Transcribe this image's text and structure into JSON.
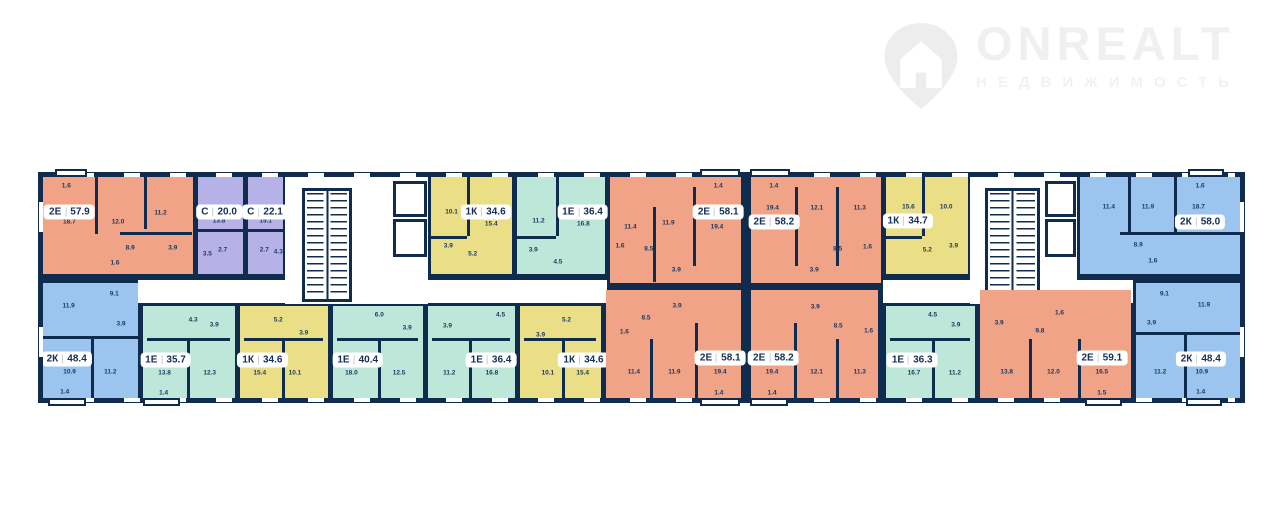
{
  "watermark": {
    "brand": "ONREALT",
    "subtitle": "НЕДВИЖИМОСТЬ"
  },
  "palette": {
    "wall": "#0f2b4d",
    "orange": "#f0a386",
    "purple": "#b6b2e8",
    "yellow": "#eadf86",
    "teal": "#bde7d8",
    "blue": "#9bc5ee",
    "paper": "#ffffff"
  },
  "building": {
    "x": 38,
    "y": 172,
    "w": 1207,
    "h": 231
  },
  "corridors": [
    {
      "x": 100,
      "y": 108,
      "w": 469,
      "h": 23
    },
    {
      "x": 845,
      "y": 108,
      "w": 250,
      "h": 23
    }
  ],
  "cores": [
    {
      "x": 247,
      "y": 0,
      "w": 143,
      "h": 132
    },
    {
      "x": 932,
      "y": 0,
      "w": 107,
      "h": 132
    }
  ],
  "stairs": [
    {
      "x": 264,
      "y": 16,
      "w": 50,
      "h": 114
    },
    {
      "x": 947,
      "y": 16,
      "w": 55,
      "h": 114
    }
  ],
  "elevators": [
    {
      "x": 355,
      "y": 9,
      "w": 34,
      "h": 36
    },
    {
      "x": 355,
      "y": 47,
      "w": 34,
      "h": 38
    },
    {
      "x": 1007,
      "y": 9,
      "w": 31,
      "h": 36
    },
    {
      "x": 1007,
      "y": 47,
      "w": 31,
      "h": 38
    }
  ],
  "balconies": [
    {
      "x": 17,
      "w": 32,
      "side": "top"
    },
    {
      "x": 662,
      "w": 40,
      "side": "top"
    },
    {
      "x": 712,
      "w": 40,
      "side": "top"
    },
    {
      "x": 1150,
      "w": 36,
      "side": "top"
    },
    {
      "x": 10,
      "w": 38,
      "side": "bottom"
    },
    {
      "x": 105,
      "w": 37,
      "side": "bottom"
    },
    {
      "x": 662,
      "w": 40,
      "side": "bottom"
    },
    {
      "x": 712,
      "w": 38,
      "side": "bottom"
    },
    {
      "x": 1047,
      "w": 37,
      "side": "bottom"
    },
    {
      "x": 1148,
      "w": 36,
      "side": "bottom"
    }
  ],
  "units": [
    {
      "id": "t1",
      "type": "2Е",
      "area": "57.9",
      "color": "orange",
      "x": 0,
      "y": 0,
      "w": 157,
      "h": 104,
      "badge": {
        "x": 19,
        "y": 38
      },
      "rooms": [
        {
          "v": "1.6",
          "x": 17,
          "y": 12
        },
        {
          "v": "18.7",
          "x": 19,
          "y": 48
        },
        {
          "v": "12.0",
          "x": 51,
          "y": 48
        },
        {
          "v": "11.2",
          "x": 79,
          "y": 39
        },
        {
          "v": "8.9",
          "x": 59,
          "y": 74
        },
        {
          "v": "3.9",
          "x": 87,
          "y": 74
        },
        {
          "v": "1.6",
          "x": 49,
          "y": 89
        }
      ],
      "walls": [
        {
          "o": "v",
          "p": 36,
          "a": 0,
          "b": 60
        },
        {
          "o": "v",
          "p": 68,
          "a": 0,
          "b": 55
        },
        {
          "o": "h",
          "p": 58,
          "a": 52,
          "b": 100
        }
      ]
    },
    {
      "id": "t2",
      "type": "С",
      "area": "20.0",
      "color": "purple",
      "x": 157,
      "y": 0,
      "w": 50,
      "h": 104,
      "badge": {
        "x": 48,
        "y": 38
      },
      "rooms": [
        {
          "v": "13.8",
          "x": 48,
          "y": 47
        },
        {
          "v": "2.7",
          "x": 56,
          "y": 76
        },
        {
          "v": "3.5",
          "x": 22,
          "y": 80
        }
      ],
      "walls": [
        {
          "o": "h",
          "p": 55,
          "a": 0,
          "b": 100
        }
      ]
    },
    {
      "id": "t3",
      "type": "С",
      "area": "22.1",
      "color": "purple",
      "x": 207,
      "y": 0,
      "w": 40,
      "h": 104,
      "badge": {
        "x": 50,
        "y": 38
      },
      "rooms": [
        {
          "v": "15.1",
          "x": 52,
          "y": 47
        },
        {
          "v": "2.7",
          "x": 48,
          "y": 76
        },
        {
          "v": "4.3",
          "x": 88,
          "y": 78
        }
      ],
      "walls": [
        {
          "o": "h",
          "p": 55,
          "a": 0,
          "b": 100
        }
      ]
    },
    {
      "id": "t4",
      "type": "1К",
      "area": "34.6",
      "color": "yellow",
      "x": 390,
      "y": 0,
      "w": 86,
      "h": 104,
      "badge": {
        "x": 68,
        "y": 38
      },
      "rooms": [
        {
          "v": "10.1",
          "x": 26,
          "y": 38
        },
        {
          "v": "15.4",
          "x": 75,
          "y": 50
        },
        {
          "v": "3.9",
          "x": 22,
          "y": 72
        },
        {
          "v": "5.2",
          "x": 52,
          "y": 80
        }
      ],
      "walls": [
        {
          "o": "v",
          "p": 45,
          "a": 0,
          "b": 62
        },
        {
          "o": "h",
          "p": 62,
          "a": 0,
          "b": 45
        }
      ]
    },
    {
      "id": "t5",
      "type": "1Е",
      "area": "36.4",
      "color": "teal",
      "x": 476,
      "y": 0,
      "w": 93,
      "h": 104,
      "badge": {
        "x": 75,
        "y": 38
      },
      "rooms": [
        {
          "v": "11.2",
          "x": 25,
          "y": 47
        },
        {
          "v": "16.8",
          "x": 76,
          "y": 50
        },
        {
          "v": "3.9",
          "x": 19,
          "y": 76
        },
        {
          "v": "4.5",
          "x": 47,
          "y": 88
        }
      ],
      "walls": [
        {
          "o": "v",
          "p": 45,
          "a": 0,
          "b": 62
        },
        {
          "o": "h",
          "p": 62,
          "a": 0,
          "b": 45
        }
      ]
    },
    {
      "id": "t6",
      "type": "2Е",
      "area": "58.1",
      "color": "orange",
      "x": 569,
      "y": 0,
      "w": 136,
      "h": 113,
      "badge": {
        "x": 83,
        "y": 35
      },
      "rooms": [
        {
          "v": "1.4",
          "x": 83,
          "y": 11
        },
        {
          "v": "19.4",
          "x": 82,
          "y": 49
        },
        {
          "v": "11.9",
          "x": 45,
          "y": 45
        },
        {
          "v": "11.4",
          "x": 16,
          "y": 49
        },
        {
          "v": "8.5",
          "x": 30,
          "y": 69
        },
        {
          "v": "1.6",
          "x": 8,
          "y": 66
        },
        {
          "v": "3.9",
          "x": 51,
          "y": 88
        }
      ],
      "walls": [
        {
          "o": "v",
          "p": 33,
          "a": 30,
          "b": 100
        },
        {
          "o": "v",
          "p": 64,
          "a": 12,
          "b": 85
        }
      ]
    },
    {
      "id": "t7",
      "type": "2Е",
      "area": "58.2",
      "color": "orange",
      "x": 710,
      "y": 0,
      "w": 135,
      "h": 113,
      "badge": {
        "x": 18,
        "y": 44
      },
      "rooms": [
        {
          "v": "1.4",
          "x": 18,
          "y": 11
        },
        {
          "v": "19.4",
          "x": 17,
          "y": 31
        },
        {
          "v": "12.1",
          "x": 51,
          "y": 31
        },
        {
          "v": "11.3",
          "x": 84,
          "y": 31
        },
        {
          "v": "8.5",
          "x": 67,
          "y": 69
        },
        {
          "v": "1.6",
          "x": 90,
          "y": 67
        },
        {
          "v": "3.9",
          "x": 49,
          "y": 88
        }
      ],
      "walls": [
        {
          "o": "v",
          "p": 34,
          "a": 12,
          "b": 85
        },
        {
          "o": "v",
          "p": 66,
          "a": 12,
          "b": 85
        }
      ]
    },
    {
      "id": "t8",
      "type": "1К",
      "area": "34.7",
      "color": "yellow",
      "x": 845,
      "y": 0,
      "w": 87,
      "h": 104,
      "badge": {
        "x": 27,
        "y": 47
      },
      "rooms": [
        {
          "v": "15.6",
          "x": 28,
          "y": 33
        },
        {
          "v": "10.0",
          "x": 74,
          "y": 33
        },
        {
          "v": "5.2",
          "x": 51,
          "y": 76
        },
        {
          "v": "3.9",
          "x": 83,
          "y": 72
        }
      ],
      "walls": [
        {
          "o": "v",
          "p": 45,
          "a": 0,
          "b": 62
        },
        {
          "o": "h",
          "p": 62,
          "a": 0,
          "b": 45
        }
      ]
    },
    {
      "id": "t9",
      "type": "2К",
      "area": "58.0",
      "color": "blue",
      "x": 1039,
      "y": 0,
      "w": 168,
      "h": 104,
      "badge": {
        "x": 74,
        "y": 48
      },
      "rooms": [
        {
          "v": "1.6",
          "x": 74,
          "y": 12
        },
        {
          "v": "11.4",
          "x": 18,
          "y": 33
        },
        {
          "v": "11.9",
          "x": 42,
          "y": 33
        },
        {
          "v": "18.7",
          "x": 73,
          "y": 33
        },
        {
          "v": "8.9",
          "x": 36,
          "y": 71
        },
        {
          "v": "1.6",
          "x": 45,
          "y": 87
        }
      ],
      "walls": [
        {
          "o": "v",
          "p": 30,
          "a": 0,
          "b": 58
        },
        {
          "o": "v",
          "p": 58,
          "a": 0,
          "b": 58
        },
        {
          "o": "h",
          "p": 58,
          "a": 25,
          "b": 100
        }
      ]
    },
    {
      "id": "c1",
      "type": "2К",
      "area": "48.4",
      "color": "blue",
      "x": 0,
      "y": 108,
      "w": 102,
      "h": 123,
      "badge": {
        "x": 27,
        "y": 65
      },
      "rooms": [
        {
          "v": "11.9",
          "x": 29,
          "y": 20
        },
        {
          "v": "9.1",
          "x": 76,
          "y": 10
        },
        {
          "v": "3.9",
          "x": 83,
          "y": 35
        },
        {
          "v": "10.9",
          "x": 30,
          "y": 76
        },
        {
          "v": "11.2",
          "x": 72,
          "y": 76
        },
        {
          "v": "1.4",
          "x": 25,
          "y": 93
        }
      ],
      "walls": [
        {
          "o": "h",
          "p": 45,
          "a": 0,
          "b": 100
        },
        {
          "o": "v",
          "p": 52,
          "a": 45,
          "b": 100
        }
      ]
    },
    {
      "id": "c2",
      "type": "1Е",
      "area": "35.7",
      "color": "teal",
      "x": 102,
      "y": 131,
      "w": 97,
      "h": 100,
      "badge": {
        "x": 25,
        "y": 57
      },
      "rooms": [
        {
          "v": "4.3",
          "x": 55,
          "y": 15
        },
        {
          "v": "3.9",
          "x": 78,
          "y": 20
        },
        {
          "v": "13.8",
          "x": 24,
          "y": 71
        },
        {
          "v": "12.3",
          "x": 73,
          "y": 71
        },
        {
          "v": "1.4",
          "x": 23,
          "y": 92
        }
      ],
      "walls": [
        {
          "o": "h",
          "p": 34,
          "a": 5,
          "b": 95
        },
        {
          "o": "v",
          "p": 48,
          "a": 34,
          "b": 100
        }
      ]
    },
    {
      "id": "c3",
      "type": "1К",
      "area": "34.6",
      "color": "yellow",
      "x": 199,
      "y": 131,
      "w": 93,
      "h": 100,
      "badge": {
        "x": 26,
        "y": 57
      },
      "rooms": [
        {
          "v": "5.2",
          "x": 44,
          "y": 15
        },
        {
          "v": "3.9",
          "x": 73,
          "y": 29
        },
        {
          "v": "15.4",
          "x": 23,
          "y": 71
        },
        {
          "v": "10.1",
          "x": 63,
          "y": 71
        }
      ],
      "walls": [
        {
          "o": "h",
          "p": 34,
          "a": 5,
          "b": 95
        },
        {
          "o": "v",
          "p": 48,
          "a": 34,
          "b": 100
        }
      ]
    },
    {
      "id": "c4",
      "type": "1Е",
      "area": "40.4",
      "color": "teal",
      "x": 292,
      "y": 131,
      "w": 95,
      "h": 100,
      "badge": {
        "x": 28,
        "y": 57
      },
      "rooms": [
        {
          "v": "6.0",
          "x": 52,
          "y": 10
        },
        {
          "v": "3.9",
          "x": 83,
          "y": 24
        },
        {
          "v": "18.0",
          "x": 21,
          "y": 71
        },
        {
          "v": "12.5",
          "x": 74,
          "y": 71
        }
      ],
      "walls": [
        {
          "o": "h",
          "p": 34,
          "a": 5,
          "b": 95
        },
        {
          "o": "v",
          "p": 50,
          "a": 34,
          "b": 100
        }
      ]
    },
    {
      "id": "c5",
      "type": "1Е",
      "area": "36.4",
      "color": "teal",
      "x": 387,
      "y": 131,
      "w": 92,
      "h": 100,
      "badge": {
        "x": 73,
        "y": 57
      },
      "rooms": [
        {
          "v": "4.5",
          "x": 84,
          "y": 10
        },
        {
          "v": "3.9",
          "x": 23,
          "y": 22
        },
        {
          "v": "11.2",
          "x": 25,
          "y": 71
        },
        {
          "v": "16.8",
          "x": 74,
          "y": 71
        }
      ],
      "walls": [
        {
          "o": "h",
          "p": 34,
          "a": 5,
          "b": 95
        },
        {
          "o": "v",
          "p": 48,
          "a": 34,
          "b": 100
        }
      ]
    },
    {
      "id": "c6",
      "type": "1К",
      "area": "34.6",
      "color": "yellow",
      "x": 479,
      "y": 131,
      "w": 86,
      "h": 100,
      "badge": {
        "x": 79,
        "y": 57
      },
      "rooms": [
        {
          "v": "5.2",
          "x": 58,
          "y": 15
        },
        {
          "v": "3.9",
          "x": 26,
          "y": 31
        },
        {
          "v": "10.1",
          "x": 35,
          "y": 71
        },
        {
          "v": "15.4",
          "x": 78,
          "y": 71
        }
      ],
      "walls": [
        {
          "o": "h",
          "p": 34,
          "a": 5,
          "b": 95
        },
        {
          "o": "v",
          "p": 52,
          "a": 34,
          "b": 100
        }
      ]
    },
    {
      "id": "c7",
      "type": "2Е",
      "area": "58.1",
      "color": "orange",
      "x": 565,
      "y": 115,
      "w": 140,
      "h": 116,
      "badge": {
        "x": 85,
        "y": 62
      },
      "rooms": [
        {
          "v": "3.9",
          "x": 53,
          "y": 15
        },
        {
          "v": "8.5",
          "x": 30,
          "y": 26
        },
        {
          "v": "1.6",
          "x": 14,
          "y": 38
        },
        {
          "v": "11.4",
          "x": 21,
          "y": 74
        },
        {
          "v": "11.9",
          "x": 51,
          "y": 74
        },
        {
          "v": "19.4",
          "x": 85,
          "y": 74
        },
        {
          "v": "1.4",
          "x": 84,
          "y": 93
        }
      ],
      "walls": [
        {
          "o": "v",
          "p": 33,
          "a": 45,
          "b": 100
        },
        {
          "o": "v",
          "p": 66,
          "a": 30,
          "b": 100
        }
      ]
    },
    {
      "id": "c8",
      "type": "2Е",
      "area": "58.2",
      "color": "orange",
      "x": 710,
      "y": 115,
      "w": 132,
      "h": 116,
      "badge": {
        "x": 18,
        "y": 62
      },
      "rooms": [
        {
          "v": "3.9",
          "x": 51,
          "y": 16
        },
        {
          "v": "8.5",
          "x": 69,
          "y": 33
        },
        {
          "v": "1.6",
          "x": 93,
          "y": 37
        },
        {
          "v": "19.4",
          "x": 17,
          "y": 74
        },
        {
          "v": "12.1",
          "x": 52,
          "y": 74
        },
        {
          "v": "11.3",
          "x": 86,
          "y": 74
        },
        {
          "v": "1.4",
          "x": 17,
          "y": 93
        }
      ],
      "walls": [
        {
          "o": "v",
          "p": 34,
          "a": 30,
          "b": 100
        },
        {
          "o": "v",
          "p": 67,
          "a": 45,
          "b": 100
        }
      ]
    },
    {
      "id": "c9",
      "type": "1Е",
      "area": "36.3",
      "color": "teal",
      "x": 845,
      "y": 131,
      "w": 94,
      "h": 100,
      "badge": {
        "x": 30,
        "y": 57
      },
      "rooms": [
        {
          "v": "4.5",
          "x": 53,
          "y": 10
        },
        {
          "v": "3.9",
          "x": 79,
          "y": 20
        },
        {
          "v": "16.7",
          "x": 32,
          "y": 71
        },
        {
          "v": "11.2",
          "x": 78,
          "y": 71
        }
      ],
      "walls": [
        {
          "o": "h",
          "p": 34,
          "a": 5,
          "b": 95
        },
        {
          "o": "v",
          "p": 52,
          "a": 34,
          "b": 100
        }
      ]
    },
    {
      "id": "c10",
      "type": "2Е",
      "area": "59.1",
      "color": "orange",
      "x": 939,
      "y": 115,
      "w": 156,
      "h": 116,
      "badge": {
        "x": 81,
        "y": 62
      },
      "rooms": [
        {
          "v": "3.9",
          "x": 13,
          "y": 30
        },
        {
          "v": "9.8",
          "x": 40,
          "y": 37
        },
        {
          "v": "1.6",
          "x": 53,
          "y": 21
        },
        {
          "v": "13.8",
          "x": 18,
          "y": 74
        },
        {
          "v": "12.0",
          "x": 49,
          "y": 74
        },
        {
          "v": "16.5",
          "x": 81,
          "y": 74
        },
        {
          "v": "1.5",
          "x": 81,
          "y": 93
        }
      ],
      "walls": [
        {
          "o": "v",
          "p": 33,
          "a": 45,
          "b": 100
        },
        {
          "o": "v",
          "p": 65,
          "a": 45,
          "b": 100
        }
      ]
    },
    {
      "id": "c11",
      "type": "2К",
      "area": "48.4",
      "color": "blue",
      "x": 1095,
      "y": 108,
      "w": 112,
      "h": 123,
      "badge": {
        "x": 61,
        "y": 65
      },
      "rooms": [
        {
          "v": "9.1",
          "x": 27,
          "y": 10
        },
        {
          "v": "11.9",
          "x": 64,
          "y": 19
        },
        {
          "v": "3.9",
          "x": 15,
          "y": 34
        },
        {
          "v": "11.2",
          "x": 23,
          "y": 76
        },
        {
          "v": "10.9",
          "x": 62,
          "y": 76
        },
        {
          "v": "1.4",
          "x": 61,
          "y": 93
        }
      ],
      "walls": [
        {
          "o": "h",
          "p": 42,
          "a": 0,
          "b": 100
        },
        {
          "o": "v",
          "p": 45,
          "a": 42,
          "b": 100
        }
      ]
    }
  ]
}
